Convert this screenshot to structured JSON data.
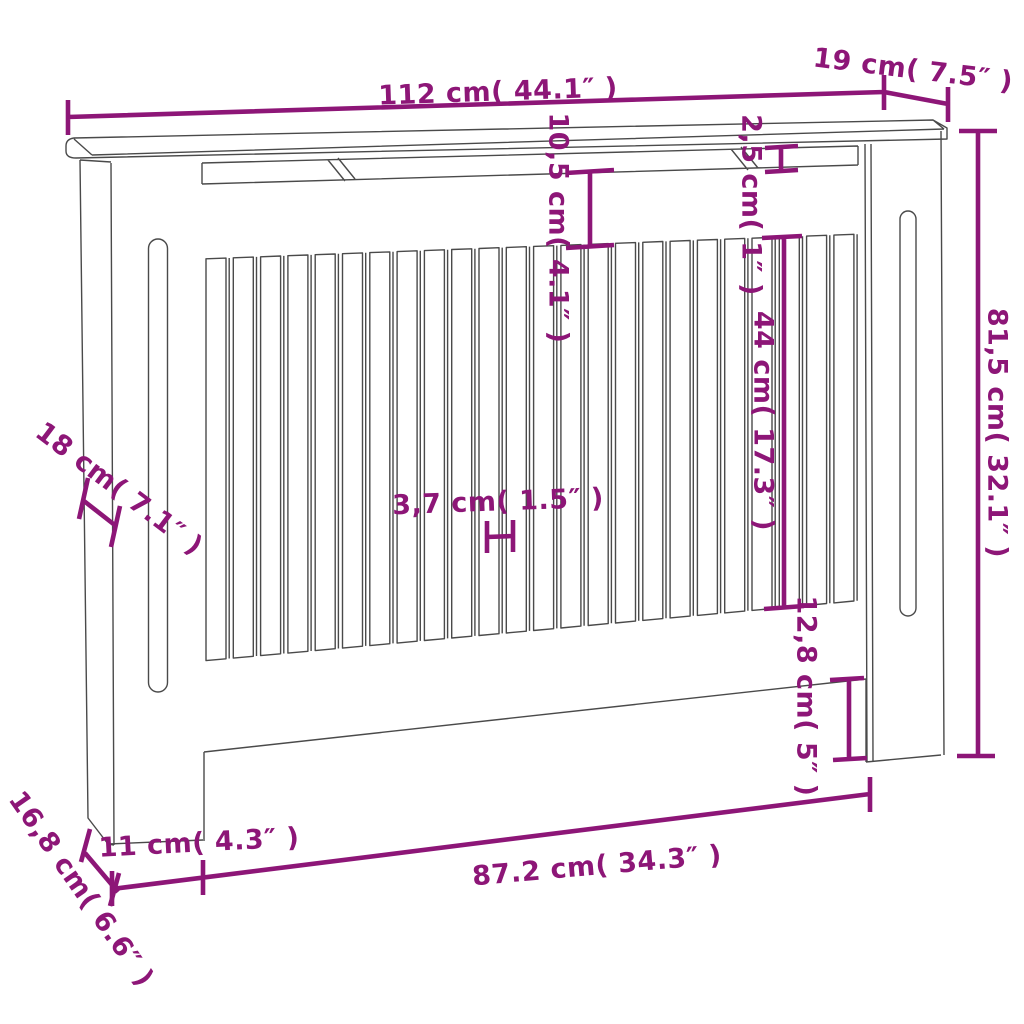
{
  "figure": {
    "colors": {
      "dimension": "#8d1677",
      "outline": "#4a4a4a",
      "background": "#ffffff"
    },
    "drawing": {
      "slat_count": 24
    },
    "dimensions": [
      {
        "id": "top-width",
        "label": "112 cm( 44.1″ )"
      },
      {
        "id": "top-depth",
        "label": "19 cm( 7.5″ )"
      },
      {
        "id": "rail-gap",
        "label": "10,5 cm( 4.1″ )"
      },
      {
        "id": "rail-thickness",
        "label": "2,5 cm( 1″ )"
      },
      {
        "id": "slat-length",
        "label": "44 cm( 17.3″ )"
      },
      {
        "id": "height",
        "label": "81,5 cm( 32.1″ )"
      },
      {
        "id": "side-width",
        "label": "18 cm( 7.1″ )"
      },
      {
        "id": "slat-pitch",
        "label": "3,7 cm( 1.5″ )"
      },
      {
        "id": "leg-height",
        "label": "12,8 cm( 5″ )"
      },
      {
        "id": "leg-width",
        "label": "11 cm( 4.3″ )"
      },
      {
        "id": "opening-width",
        "label": "87.2 cm( 34.3″ )"
      },
      {
        "id": "side-depth",
        "label": "16,8 cm( 6.6″ )"
      }
    ]
  }
}
